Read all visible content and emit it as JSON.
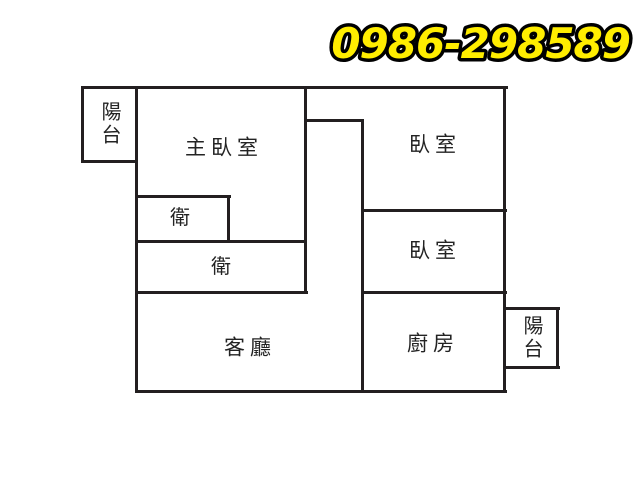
{
  "header": {
    "phone": "0986-298589",
    "phone_color": "#ffed00",
    "phone_outline_color": "#000000"
  },
  "floorplan": {
    "background": "#ffffff",
    "wall_color": "#231f20",
    "label_color": "#232323",
    "rooms": [
      {
        "id": "balcony-top-left",
        "label": "陽台",
        "orientation": "vertical"
      },
      {
        "id": "master-bedroom",
        "label": "主臥室",
        "orientation": "horizontal"
      },
      {
        "id": "bedroom-top-right",
        "label": "臥室",
        "orientation": "horizontal"
      },
      {
        "id": "bathroom-small",
        "label": "衛",
        "orientation": "horizontal"
      },
      {
        "id": "bathroom-large",
        "label": "衛",
        "orientation": "horizontal"
      },
      {
        "id": "bedroom-middle-right",
        "label": "臥室",
        "orientation": "horizontal"
      },
      {
        "id": "living-room",
        "label": "客廳",
        "orientation": "horizontal"
      },
      {
        "id": "kitchen",
        "label": "廚房",
        "orientation": "horizontal"
      },
      {
        "id": "balcony-right",
        "label": "陽台",
        "orientation": "vertical"
      }
    ],
    "walls": [
      {
        "x": 81,
        "y": 86,
        "w": 427,
        "h": 3
      },
      {
        "x": 81,
        "y": 160,
        "w": 57,
        "h": 3
      },
      {
        "x": 135,
        "y": 195,
        "w": 96,
        "h": 3
      },
      {
        "x": 135,
        "y": 240,
        "w": 172,
        "h": 3
      },
      {
        "x": 135,
        "y": 291,
        "w": 173,
        "h": 3
      },
      {
        "x": 304,
        "y": 119,
        "w": 60,
        "h": 3
      },
      {
        "x": 361,
        "y": 209,
        "w": 146,
        "h": 3
      },
      {
        "x": 361,
        "y": 291,
        "w": 146,
        "h": 3
      },
      {
        "x": 135,
        "y": 390,
        "w": 372,
        "h": 3
      },
      {
        "x": 504,
        "y": 307,
        "w": 56,
        "h": 3
      },
      {
        "x": 504,
        "y": 366,
        "w": 56,
        "h": 3
      },
      {
        "x": 81,
        "y": 86,
        "w": 3,
        "h": 77
      },
      {
        "x": 135,
        "y": 86,
        "w": 3,
        "h": 307
      },
      {
        "x": 227,
        "y": 195,
        "w": 3,
        "h": 48
      },
      {
        "x": 304,
        "y": 86,
        "w": 3,
        "h": 208
      },
      {
        "x": 361,
        "y": 119,
        "w": 3,
        "h": 274
      },
      {
        "x": 503,
        "y": 86,
        "w": 3,
        "h": 307
      },
      {
        "x": 556,
        "y": 307,
        "w": 3,
        "h": 62
      }
    ]
  }
}
